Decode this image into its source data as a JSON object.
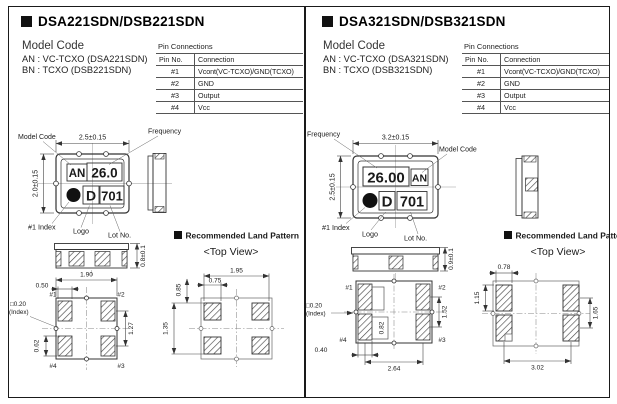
{
  "panels": [
    {
      "title": "DSA221SDN/DSB221SDN",
      "model_code": {
        "heading": "Model Code",
        "line1": "AN : VC-TCXO (DSA221SDN)",
        "line2": "BN : TCXO (DSB221SDN)"
      },
      "pin_connections": {
        "caption": "Pin Connections",
        "col_pin": "Pin No.",
        "col_conn": "Connection",
        "rows": [
          [
            "#1",
            "Vcont(VC-TCXO)/GND(TCXO)"
          ],
          [
            "#2",
            "GND"
          ],
          [
            "#3",
            "Output"
          ],
          [
            "#4",
            "Vcc"
          ]
        ]
      },
      "top_view": {
        "dim_width": "2.5±0.15",
        "dim_height": "2.0±0.15",
        "label_model_code": "Model Code",
        "label_frequency": "Frequency",
        "label_index": "#1 Index",
        "label_logo": "Logo",
        "label_lot": "Lot No.",
        "mark_model": "AN",
        "mark_freq": "26.0",
        "mark_logo": "D",
        "mark_lot": "701"
      },
      "front_view": {
        "dim_thickness": "0.8±0.1"
      },
      "bottom_view": {
        "pin1": "#1",
        "pin2": "#2",
        "pin3": "#3",
        "pin4": "#4",
        "index_line1": "□0.20",
        "index_line2": "(Index)",
        "dim_pad_w": "0.50",
        "dim_body_w": "1.90",
        "dim_pitch_v": "1.27",
        "dim_pad_h": "0.62"
      },
      "land_pattern": {
        "heading": "Recommended Land Pattern",
        "subheading": "<Top View>",
        "dim_w": "1.95",
        "dim_pad_w": "0.75",
        "dim_pad_h": "0.85",
        "dim_pitch_v": "1.35"
      }
    },
    {
      "title": "DSA321SDN/DSB321SDN",
      "model_code": {
        "heading": "Model Code",
        "line1": "AN : VC-TCXO (DSA321SDN)",
        "line2": "BN : TCXO (DSB321SDN)"
      },
      "pin_connections": {
        "caption": "Pin Connections",
        "col_pin": "Pin No.",
        "col_conn": "Connection",
        "rows": [
          [
            "#1",
            "Vcont(VC-TCXO)/GND(TCXO)"
          ],
          [
            "#2",
            "GND"
          ],
          [
            "#3",
            "Output"
          ],
          [
            "#4",
            "Vcc"
          ]
        ]
      },
      "top_view": {
        "dim_width": "3.2±0.15",
        "dim_height": "2.5±0.15",
        "label_model_code": "Model Code",
        "label_frequency": "Frequency",
        "label_index": "#1 Index",
        "label_logo": "Logo",
        "label_lot": "Lot No.",
        "mark_model": "AN",
        "mark_freq": "26.00",
        "mark_logo": "D",
        "mark_lot": "701"
      },
      "front_view": {
        "dim_thickness": "0.9±0.1"
      },
      "bottom_view": {
        "pin1": "#1",
        "pin2": "#2",
        "pin3": "#3",
        "pin4": "#4",
        "index_line1": "□0.20",
        "index_line2": "(Index)",
        "dim_pitch_v": "1.52",
        "dim_pad_inner": "0.82",
        "dim_pad_w": "0.40",
        "dim_span": "2.64"
      },
      "land_pattern": {
        "heading": "Recommended Land Pattern",
        "subheading": "<Top View>",
        "dim_pad_w": "0.78",
        "dim_pad_h": "1.15",
        "dim_pitch_v": "1.65",
        "dim_w": "3.02"
      }
    }
  ]
}
